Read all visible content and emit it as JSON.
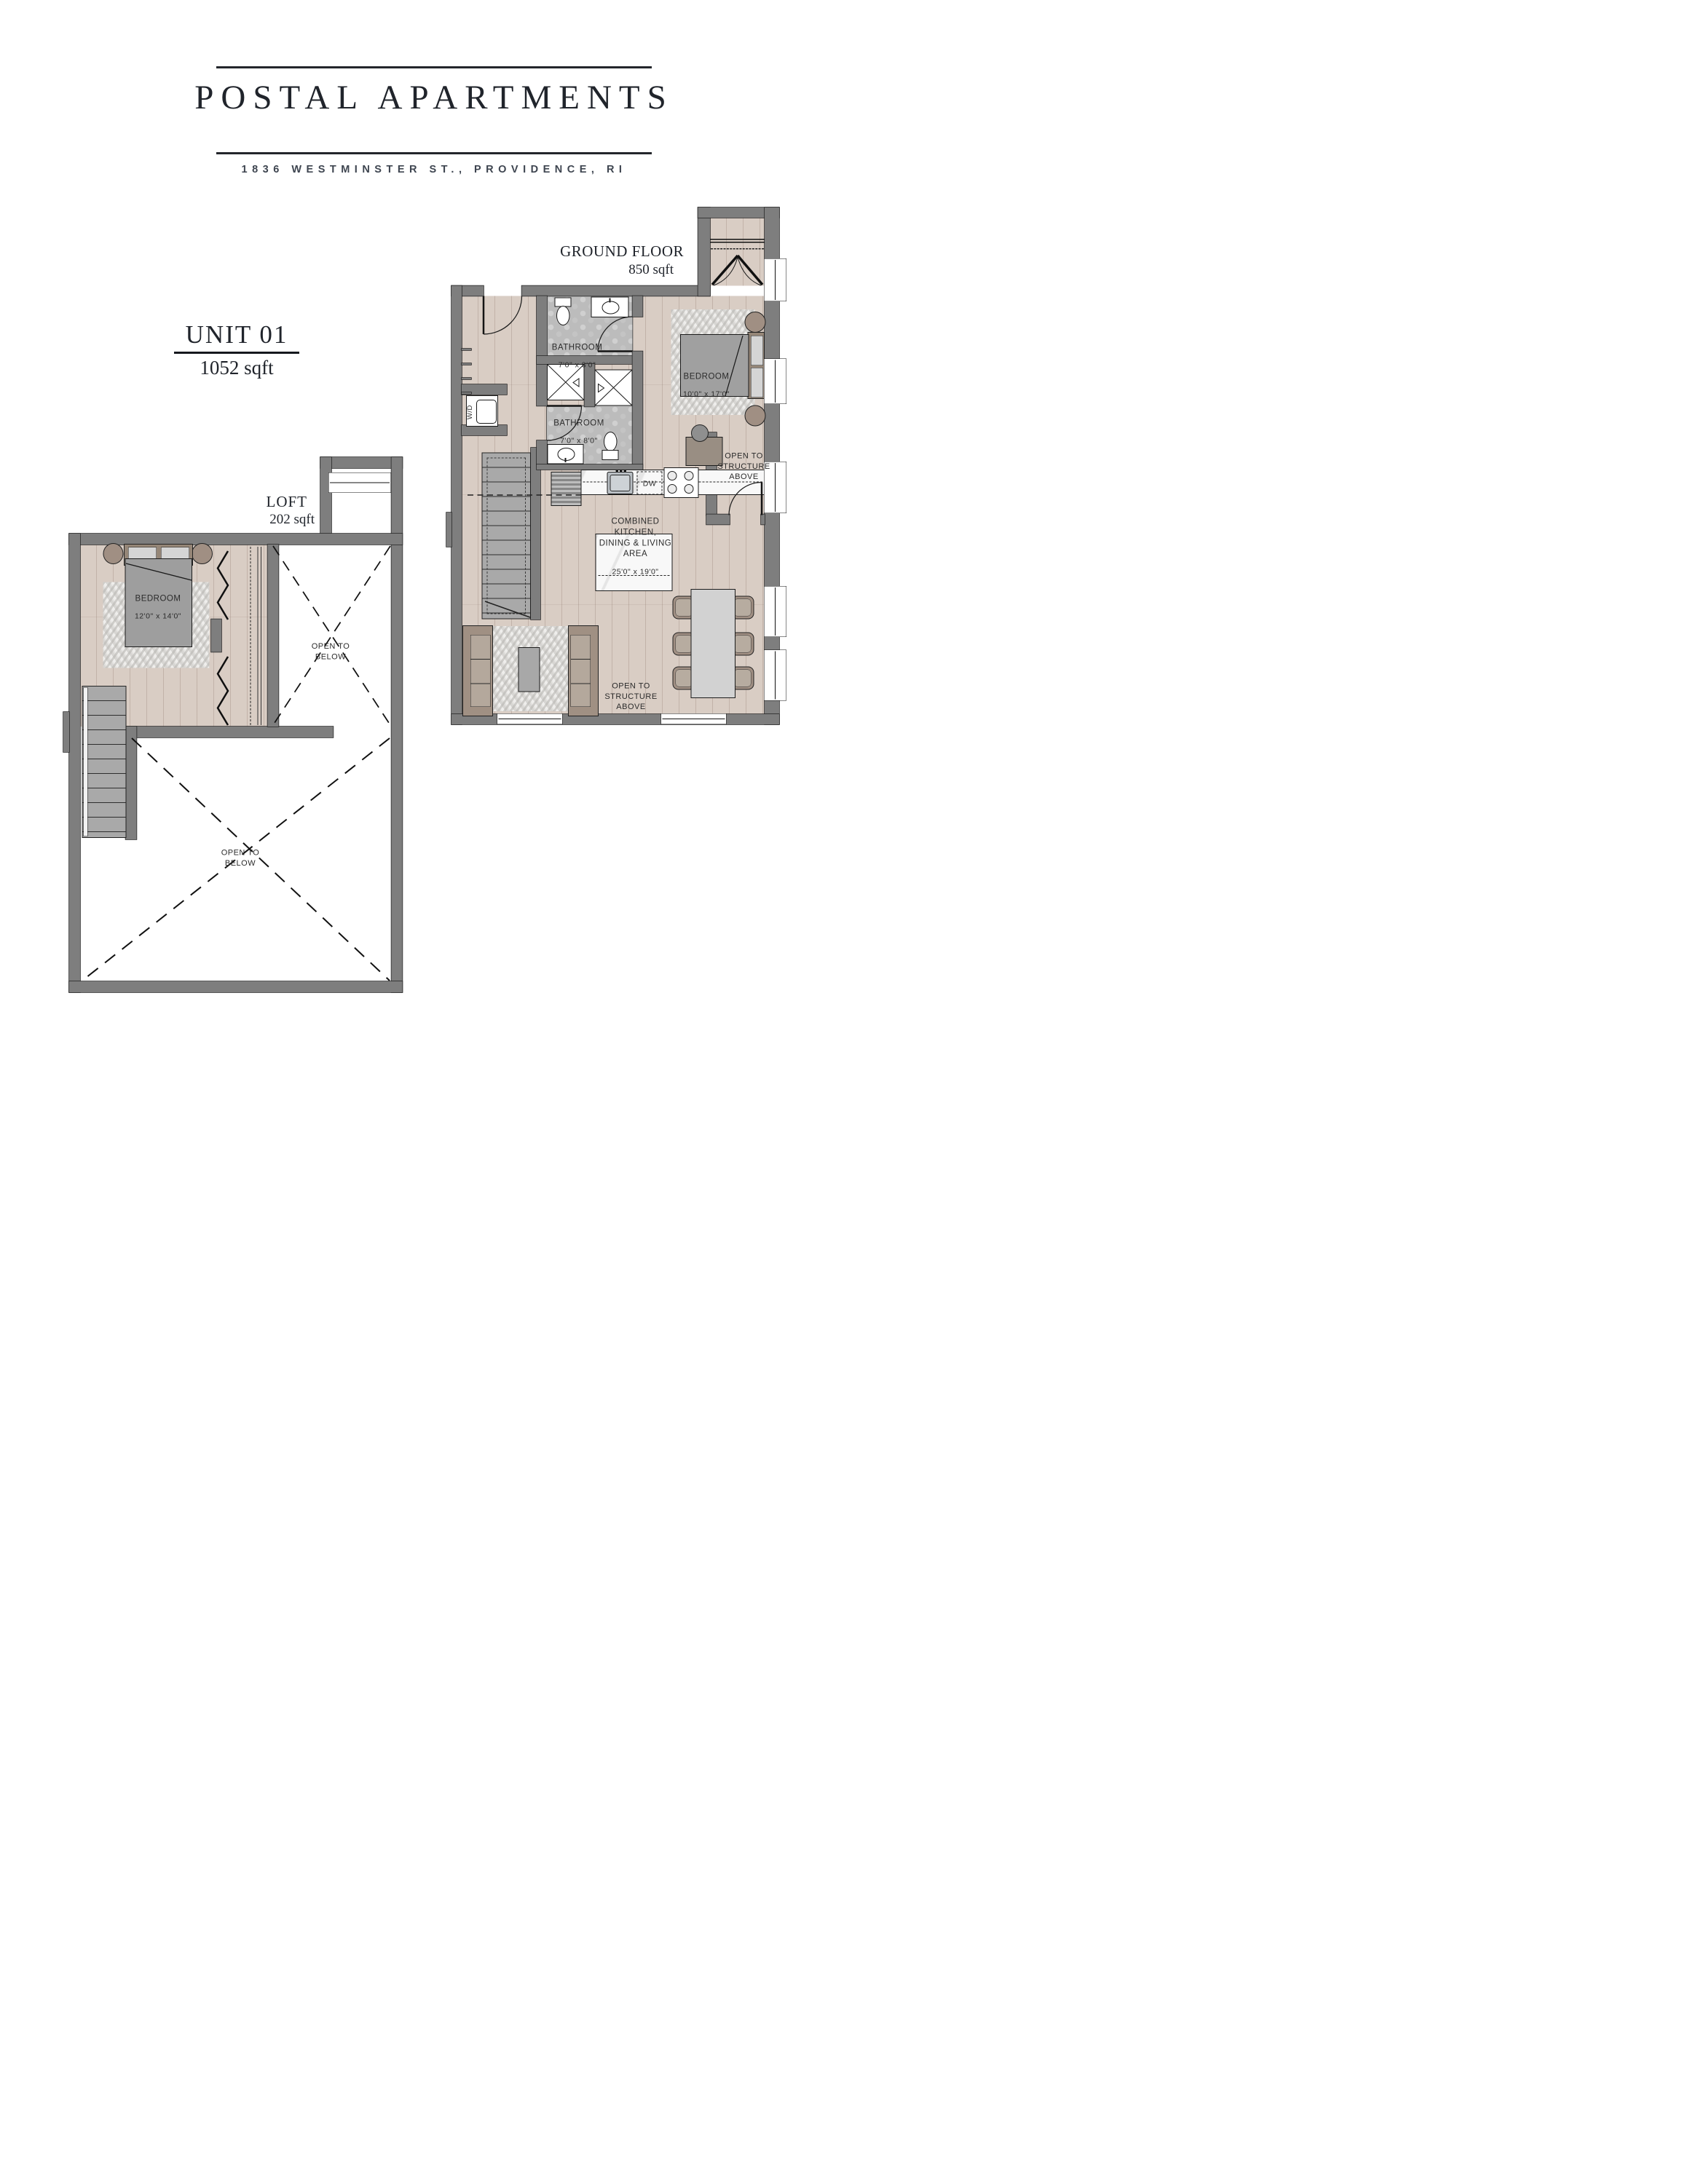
{
  "header": {
    "title": "POSTAL APARTMENTS",
    "address": "1836 WESTMINSTER ST., PROVIDENCE, RI"
  },
  "unit": {
    "name": "UNIT 01",
    "area": "1052 sqft"
  },
  "ground_floor": {
    "title": "GROUND FLOOR",
    "area": "850 sqft",
    "bathroom1": {
      "name": "BATHROOM",
      "dims": "7'0\" x 8'0\""
    },
    "bathroom2": {
      "name": "BATHROOM",
      "dims": "7'0\" x 8'0\""
    },
    "bedroom": {
      "name": "BEDROOM",
      "dims": "10'0\" x 17'0\""
    },
    "kitchen": {
      "name": "COMBINED KITCHEN,\nDINING & LIVING AREA",
      "dims": "25'0\" x 19'0\""
    },
    "open_structure": "OPEN TO\nSTRUCTURE\nABOVE",
    "washer_dryer": "W/D",
    "dishwasher": "DW"
  },
  "loft": {
    "title": "LOFT",
    "area": "202 sqft",
    "bedroom": {
      "name": "BEDROOM",
      "dims": "12'0\" x 14'0\""
    },
    "open_below": "OPEN TO\nBELOW"
  },
  "colors": {
    "wall": "#7e7e7e",
    "wood": "#d9cdc4",
    "tile": "#bcbcbc",
    "accent_tan": "#a08f83",
    "line": "#1a1a1a"
  }
}
